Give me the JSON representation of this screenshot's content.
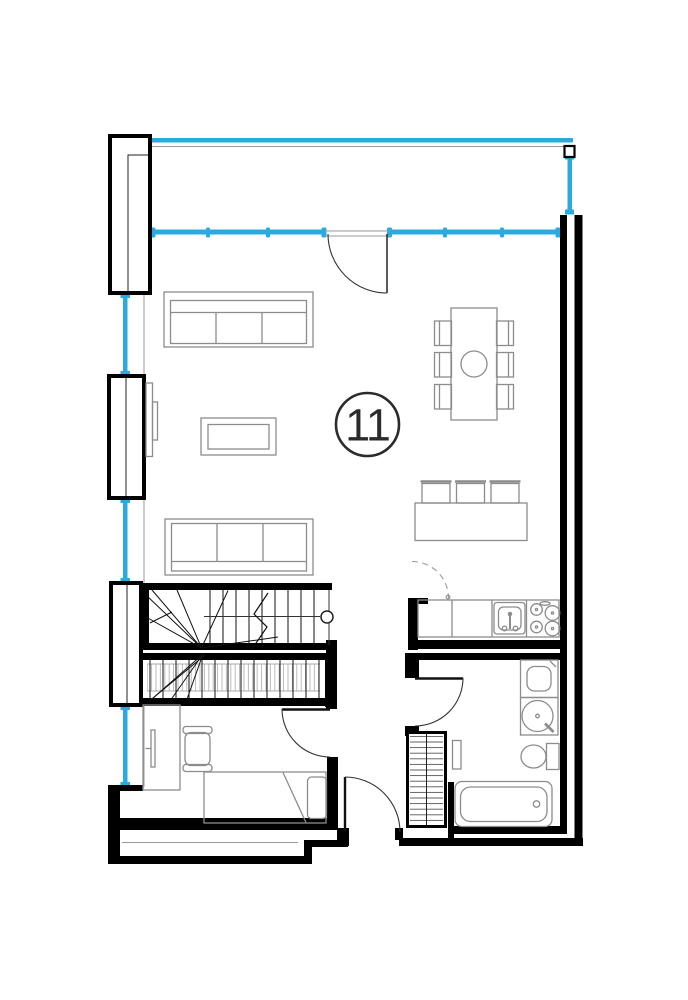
{
  "unit": {
    "number": "11"
  },
  "palette": {
    "wall": "#000000",
    "furniture": "#8c8c8c",
    "window": "#29abe2",
    "door": "#333333",
    "label": "#2b2b2b",
    "hatch": "#aaaaaa",
    "background": "#ffffff"
  },
  "inventory": {
    "living_room": [
      "sofa",
      "sofa",
      "coffee-table",
      "wall-tv",
      "dining-table",
      "dining-chairs-x6"
    ],
    "kitchen": [
      "island-counter",
      "bar-stools-x3",
      "worktop",
      "sink",
      "cooktop-4-burner",
      "appliance-swing-dashed"
    ],
    "bathroom": [
      "washing-machine",
      "round-basin",
      "toilet",
      "bathtub",
      "shelf"
    ],
    "bedroom": [
      "desk",
      "monitor",
      "office-chair",
      "single-bed",
      "pillow"
    ],
    "circulation": [
      "switchback-staircase",
      "stair-handrail",
      "entry-door",
      "bedroom-door",
      "bathroom-door",
      "balcony-door"
    ],
    "envelope": [
      "balcony-rail-band",
      "window-band-top",
      "side-windows-x3",
      "wall-piers-x4",
      "service-shaft"
    ]
  }
}
